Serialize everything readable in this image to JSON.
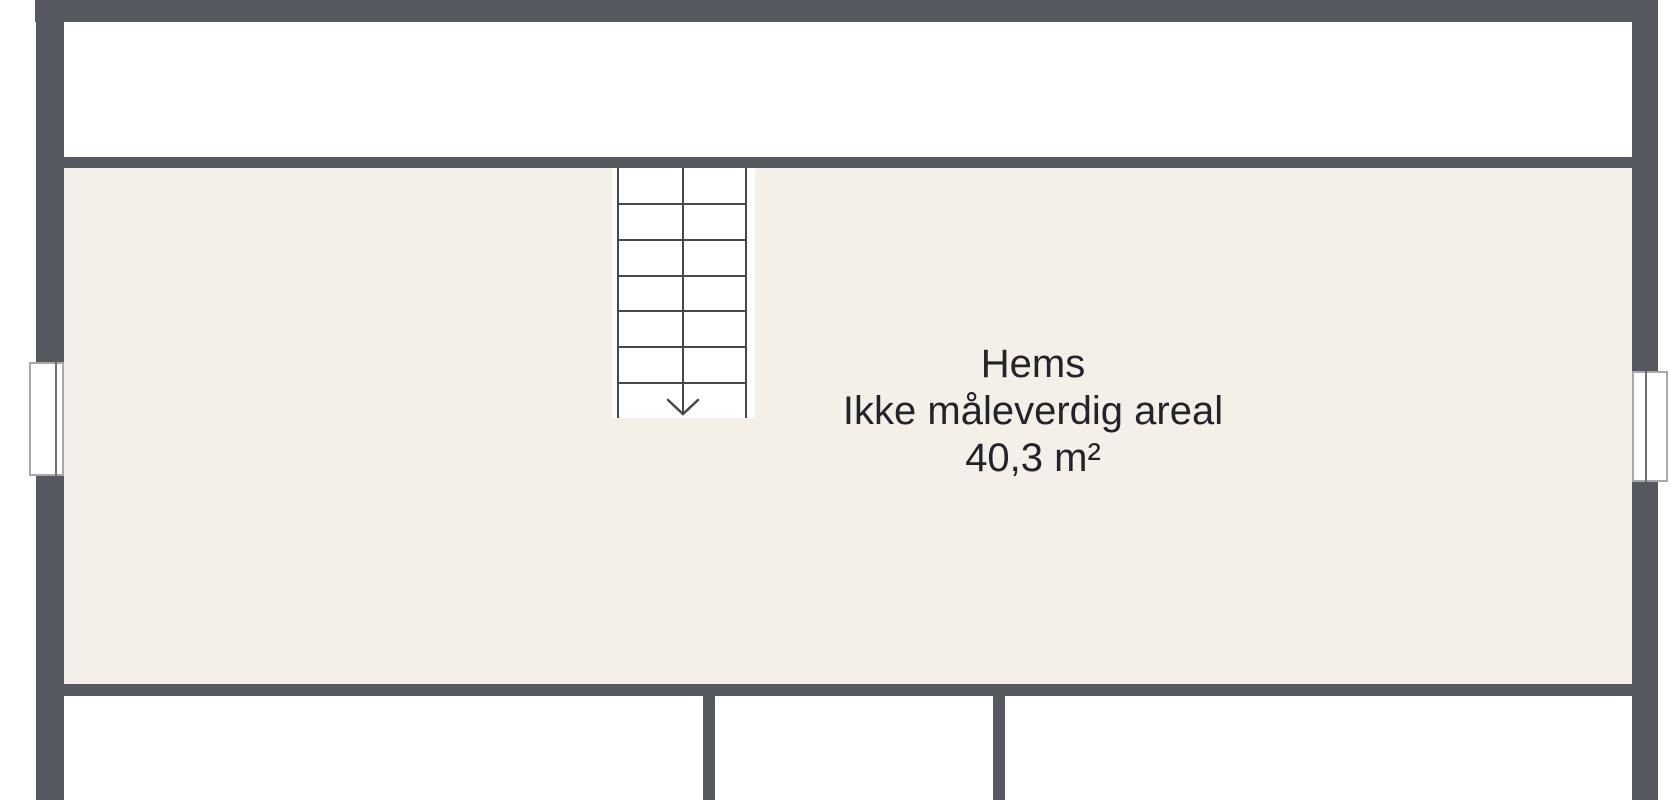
{
  "room_label": {
    "name": "Hems",
    "note": "Ikke måleverdig areal",
    "area": "40,3 m²"
  },
  "stairs": {
    "direction": "down",
    "tread_lines": 6
  },
  "colors": {
    "wall": "#56595f",
    "hems_floor": "#f5f0e7",
    "room_floor": "#ffffff",
    "label_text": "#23232b",
    "stair_line": "#45484d",
    "window_frame": "#a9a9a9",
    "window_glass": "#707070"
  }
}
